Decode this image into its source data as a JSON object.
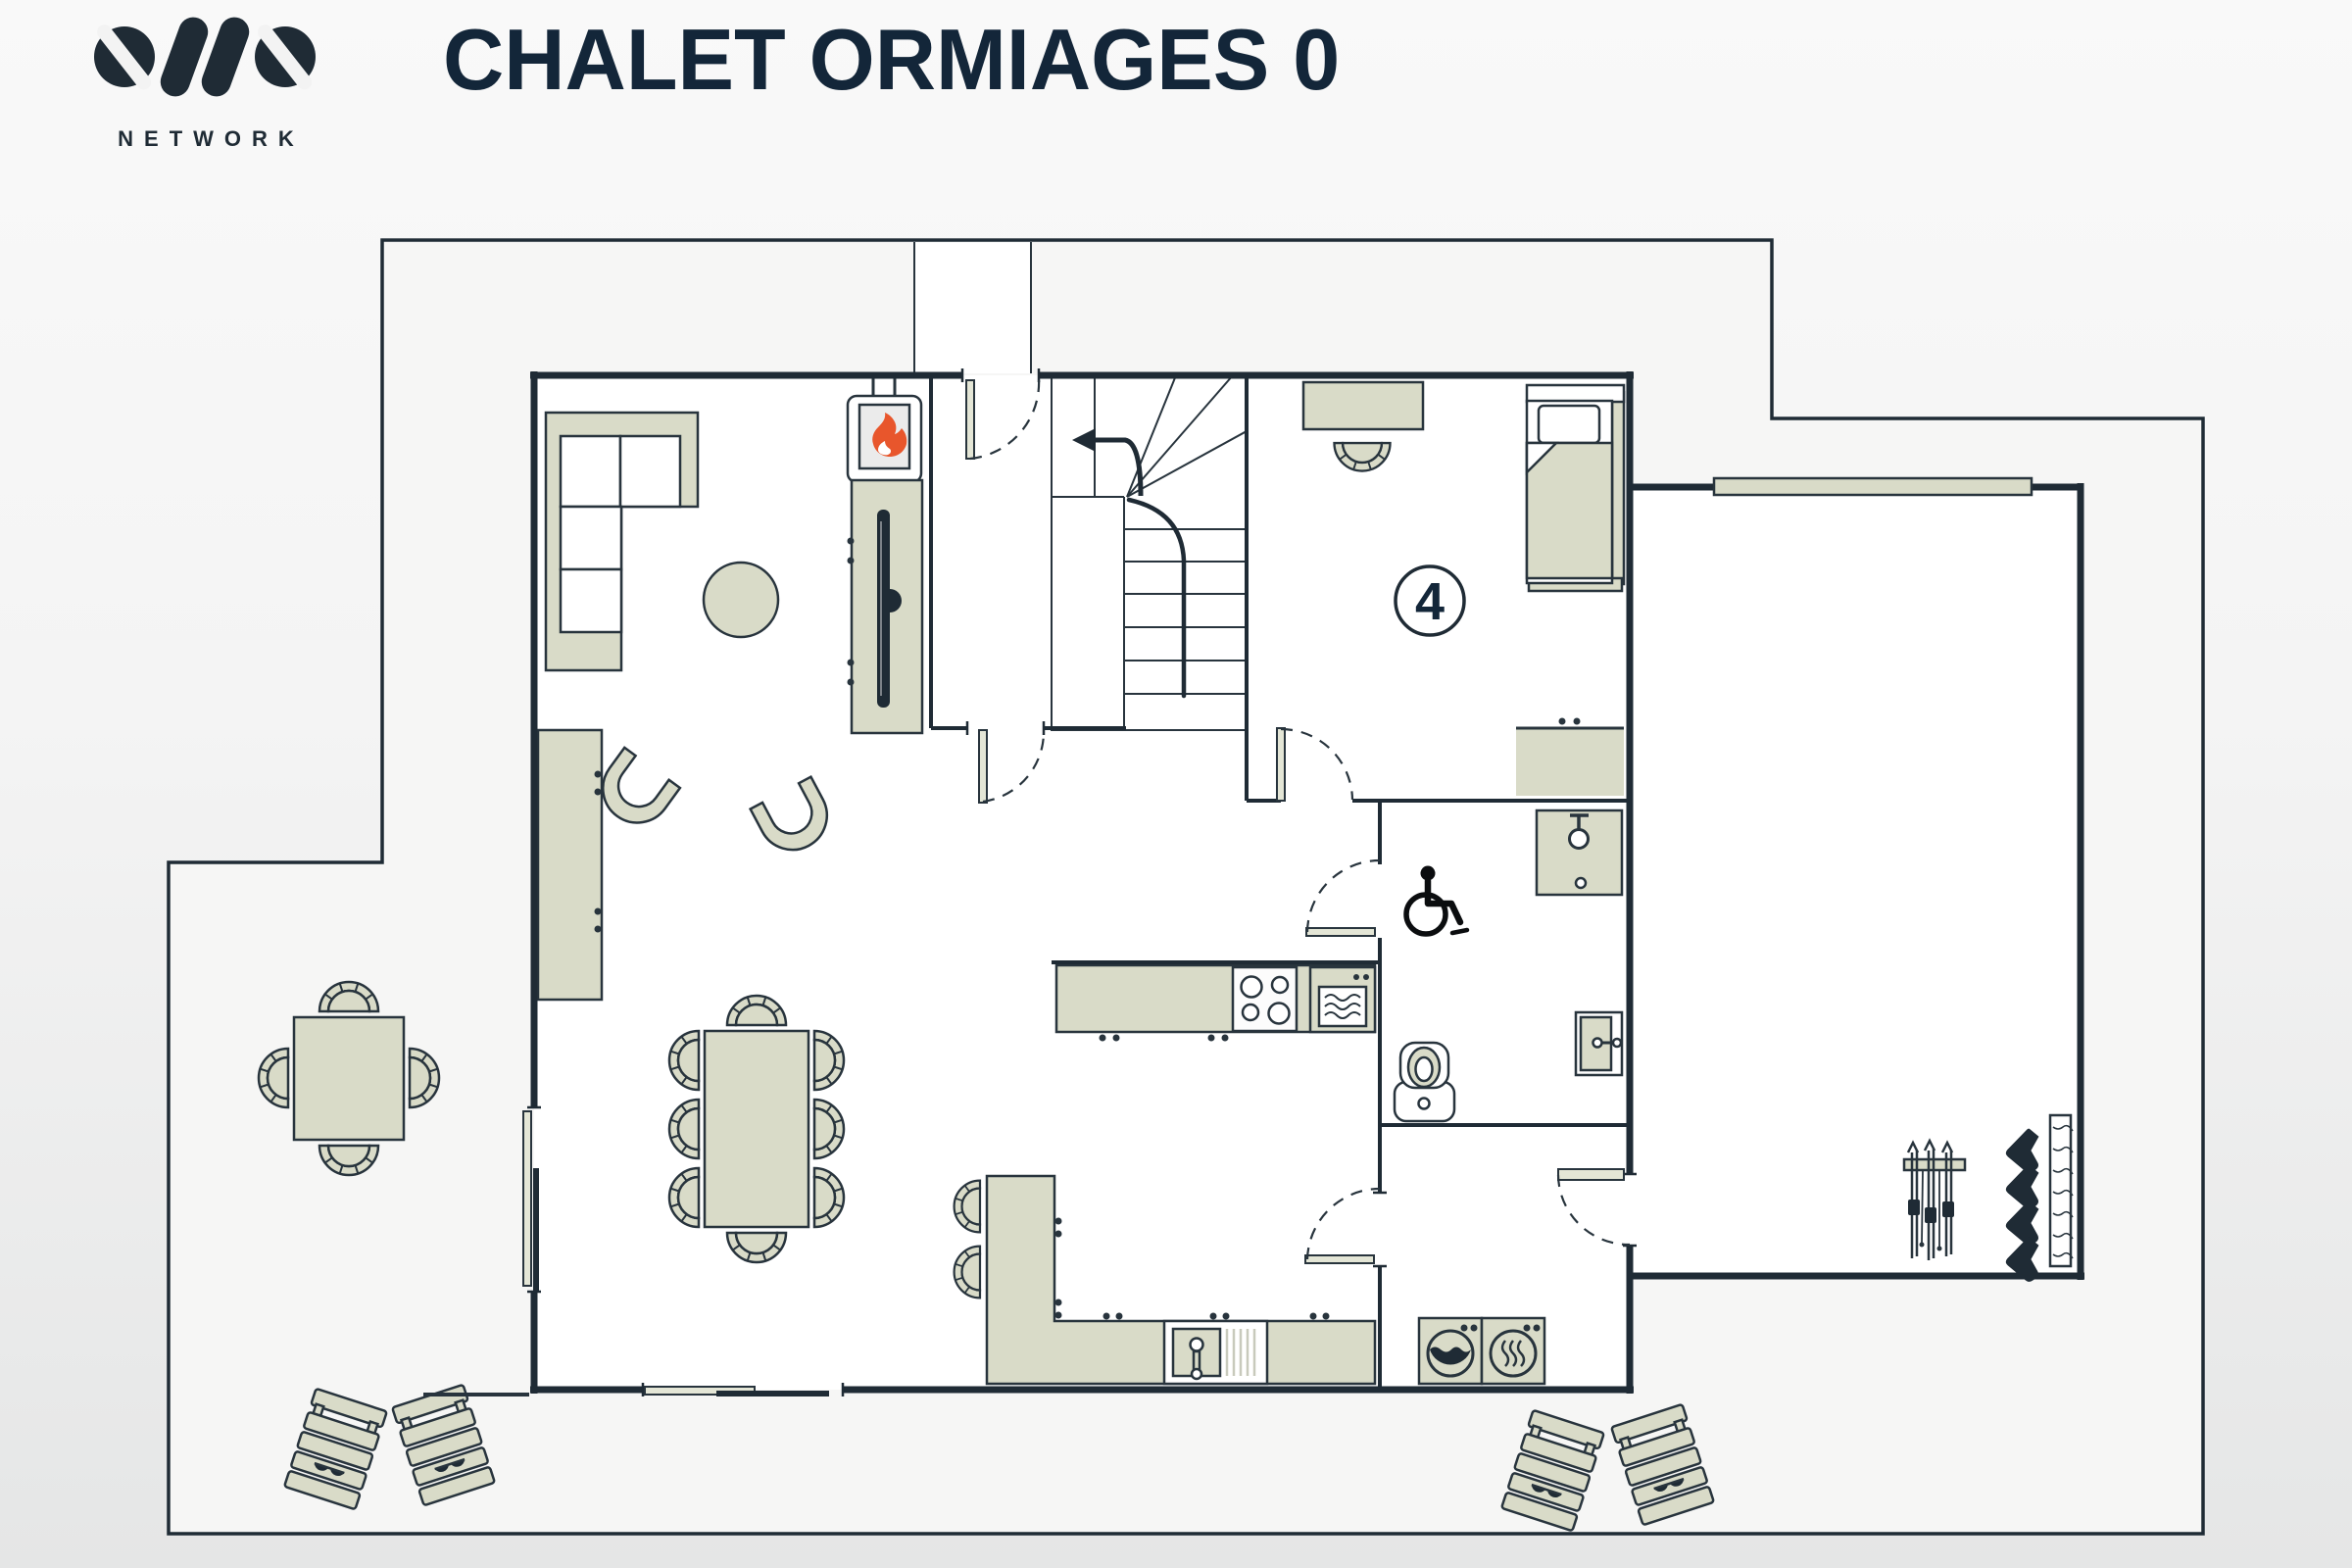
{
  "header": {
    "logo_primary": "OVO",
    "logo_secondary": "NETWORK",
    "title": "CHALET ORMIAGES 0"
  },
  "floor_plan": {
    "bedroom_number": "4",
    "rooms": [
      {
        "name": "living-dining-kitchen",
        "items": [
          "corner-sofa",
          "coffee-table",
          "armchair",
          "armchair",
          "wood-stove",
          "tv-console",
          "sideboard",
          "dining-table",
          "8-chairs",
          "kitchen-counter",
          "hob",
          "oven",
          "sink",
          "breakfast-peninsula",
          "2-bar-stools"
        ]
      },
      {
        "name": "hall-staircase",
        "items": [
          "staircase",
          "up-arrow",
          "entrance-door"
        ]
      },
      {
        "name": "bedroom-4",
        "items": [
          "desk",
          "desk-chair",
          "single-bed",
          "chest-of-drawers",
          "room-number-badge"
        ]
      },
      {
        "name": "accessible-bathroom",
        "items": [
          "shower",
          "wheelchair-symbol",
          "toilet",
          "bathroom-cabinet"
        ]
      },
      {
        "name": "laundry",
        "items": [
          "washing-machine",
          "tumble-dryer"
        ]
      },
      {
        "name": "ski-room",
        "items": [
          "ski-rack",
          "boot-warmer",
          "window"
        ]
      },
      {
        "name": "terrace",
        "items": [
          "outdoor-table",
          "4-outdoor-chairs",
          "sun-lounger",
          "sun-lounger",
          "sun-lounger",
          "sun-lounger"
        ]
      }
    ],
    "icons": [
      "flame-icon",
      "tv-icon",
      "stairs-up-arrow-icon",
      "wheelchair-accessible-icon",
      "shower-head-icon",
      "toilet-icon",
      "sink-faucet-icon",
      "hob-burners-icon",
      "oven-icon",
      "washing-machine-icon",
      "tumble-dryer-heat-icon",
      "ski-rack-icon",
      "ski-boot-warmer-icon",
      "sunglasses-icon",
      "door-swing-icon",
      "sliding-door-icon",
      "window-icon"
    ]
  },
  "colors": {
    "wall": "#1f2b35",
    "outline": "#28343d",
    "furniture": "#d9dbc8",
    "floor": "#ffffff",
    "terrace": "#f6f6f5",
    "flame": "#e8562c",
    "title_text": "#132639",
    "bg_top": "#f9f9f9",
    "bg_bottom": "#e5e6e6"
  }
}
